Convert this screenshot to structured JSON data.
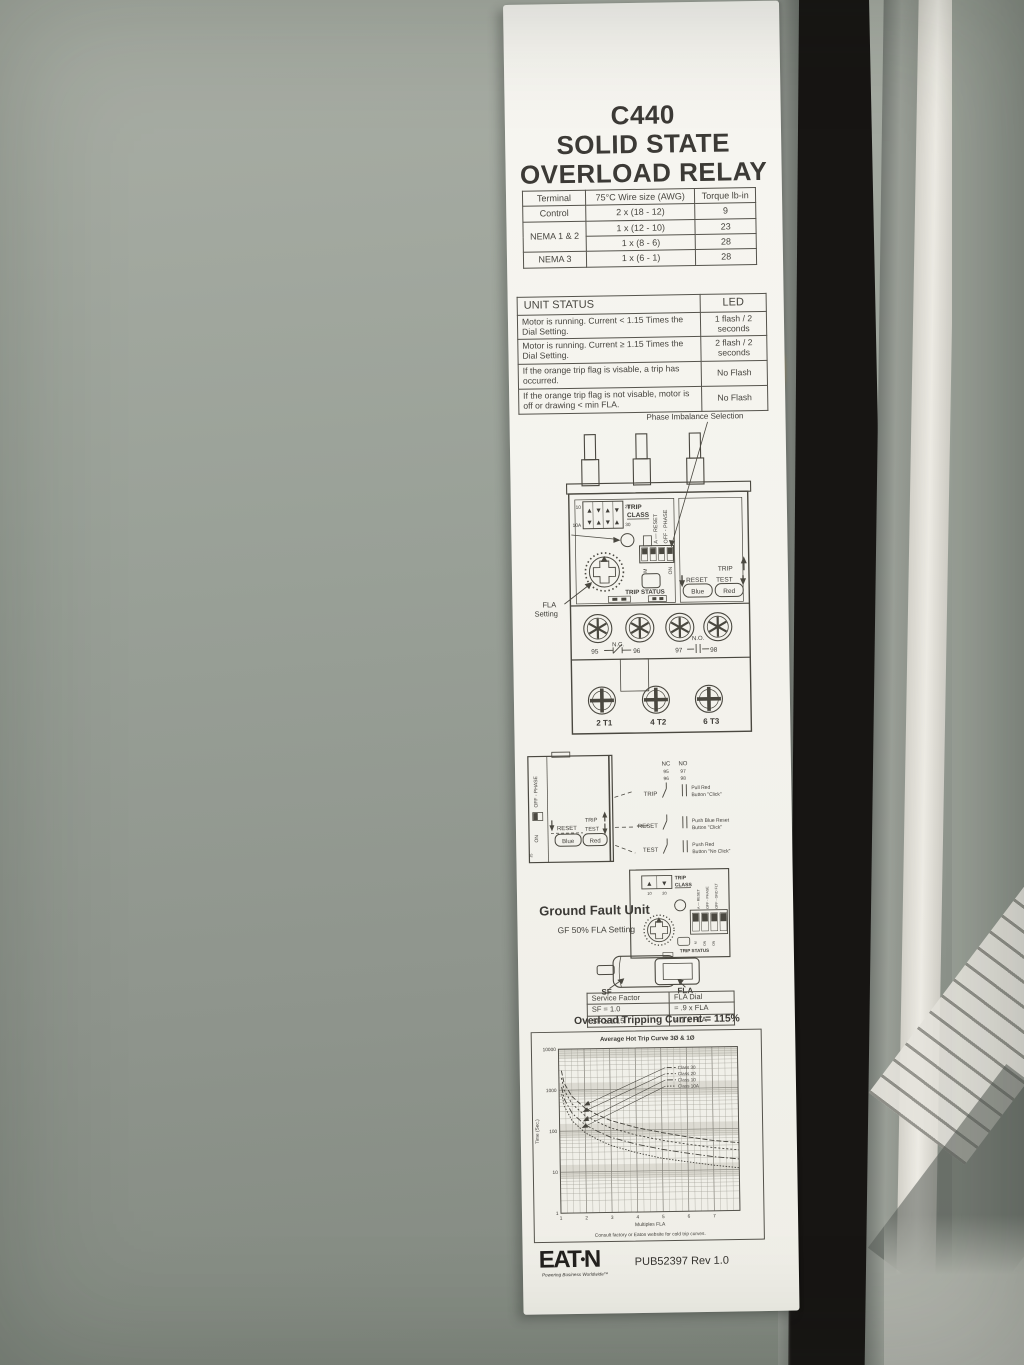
{
  "colors": {
    "panel": "#9aa098",
    "label_bg": "#f5f4ef",
    "ink": "#3f3d38",
    "gasket": "#171513",
    "highlight": "#efede6"
  },
  "label": {
    "title": [
      "C440",
      "SOLID STATE",
      "OVERLOAD RELAY"
    ],
    "wire_table": {
      "headers": [
        "Terminal",
        "75°C Wire size (AWG)",
        "Torque lb-in"
      ],
      "rows": [
        {
          "terminal": "Control",
          "wire": "2 x (18 - 12)",
          "torque": "9"
        },
        {
          "terminal": "NEMA 1 & 2",
          "wire": "1 x (12 - 10)",
          "torque": "23"
        },
        {
          "terminal": "",
          "wire": "1 x (8 - 6)",
          "torque": "28"
        },
        {
          "terminal": "NEMA 3",
          "wire": "1 x (6 - 1)",
          "torque": "28"
        }
      ]
    },
    "unit_status_table": {
      "headers": [
        "UNIT STATUS",
        "LED"
      ],
      "rows": [
        {
          "status": "Motor is running. Current < 1.15 Times the Dial Setting.",
          "led": "1 flash / 2 seconds"
        },
        {
          "status": "Motor is running. Current ≥ 1.15 Times the Dial Setting.",
          "led": "2 flash / 2 seconds"
        },
        {
          "status": "If the orange trip flag is visable, a trip has occurred.",
          "led": "No Flash"
        },
        {
          "status": "If the orange trip flag is not visable, motor is off or drawing < min FLA.",
          "led": "No Flash"
        }
      ]
    },
    "device": {
      "phase_imbalance": "Phase Imbalance Selection",
      "trip": "TRIP",
      "class": "CLASS",
      "classes": [
        "10",
        "20",
        "10A",
        "30"
      ],
      "arrows_row1": "▲▼▲▼",
      "arrows_row2": "▼▲▼▲",
      "dip_top": [
        "A — RESET",
        "OFF - PHASE"
      ],
      "dip_bottom": [
        "M",
        "ON"
      ],
      "trip_status": "TRIP STATUS",
      "fla_l1": "FLA",
      "fla_l2": "Setting",
      "trip_label": "TRIP",
      "reset_label": "RESET",
      "test_label": "TEST",
      "blue": "Blue",
      "red": "Red",
      "nc": "N.C.",
      "no": "N.O.",
      "n95": "95",
      "n96": "96",
      "n97": "97",
      "n98": "98",
      "t1": "2 T1",
      "t2": "4 T2",
      "t3": "6 T3"
    },
    "mid": {
      "off_phase": "OFF - PHASE",
      "on": "ON",
      "j5": "J5",
      "reset": "RESET",
      "trip": "TRIP",
      "test": "TEST",
      "blue": "Blue",
      "red": "Red",
      "nc": "NC",
      "no": "NO",
      "r95": "95",
      "r97": "97",
      "r96": "96",
      "r98": "98",
      "rows": [
        {
          "name": "TRIP",
          "desc1": "Pull Red",
          "desc2": "Button \"Click\""
        },
        {
          "name": "RESET",
          "desc1": "Push Blue Reset",
          "desc2": "Button \"Click\""
        },
        {
          "name": "TEST",
          "desc1": "Push Red",
          "desc2": "Button \"No Click\""
        }
      ]
    },
    "gf": {
      "title": "Ground Fault Unit",
      "subtitle": "GF 50% FLA Setting",
      "trip": "TRIP",
      "class": "CLASS",
      "c10": "10",
      "c20": "20",
      "dip_top": [
        "A — RESET",
        "OFF - PHASE",
        "OFF - GND FLT"
      ],
      "dip_bottom": [
        "M",
        "ON",
        "ON"
      ],
      "trip_status": "TRIP STATUS"
    },
    "sf": {
      "sf": "SF",
      "fla": "FLA"
    },
    "service_table": {
      "headers": [
        "Service Factor",
        "FLA Dial"
      ],
      "rows": [
        [
          "SF = 1.0",
          "= .9 x FLA"
        ],
        [
          "SF ≥ 1.15",
          "= 1 x FLA"
        ]
      ]
    },
    "overload_line": "Overload Tripping Current = 115%",
    "footer": {
      "brand_e": "E",
      "brand_a": "A",
      "brand_t": "T",
      "brand_dot": "•",
      "brand_n": "N",
      "tagline": "Powering Business Worldwide™",
      "pub": "PUB52397 Rev 1.0"
    }
  },
  "chart_data": {
    "type": "line",
    "title": "Average Hot Trip Curve 3Ø & 1Ø",
    "xlabel": "Multiples FLA",
    "ylabel": "Time (Sec.)",
    "note": "Consult factory or Eaton website for cold trip curves.",
    "x_ticks": [
      1,
      2,
      3,
      4,
      5,
      6,
      7
    ],
    "y_ticks": [
      10000,
      1000,
      100,
      10,
      1
    ],
    "xlim": [
      1,
      8
    ],
    "ylim": [
      1,
      10000
    ],
    "y_log": true,
    "grid": true,
    "legend_position": "upper right",
    "series": [
      {
        "name": "Class 30",
        "dash": "5,2",
        "arrow_x": 1.95,
        "points": [
          [
            1.1,
            3000
          ],
          [
            1.2,
            1500
          ],
          [
            1.5,
            700
          ],
          [
            2,
            360
          ],
          [
            2.5,
            240
          ],
          [
            3,
            175
          ],
          [
            4,
            115
          ],
          [
            5,
            85
          ],
          [
            6,
            65
          ],
          [
            7,
            52
          ],
          [
            8,
            45
          ]
        ]
      },
      {
        "name": "Class 20",
        "dash": "2,2",
        "arrow_x": 1.9,
        "points": [
          [
            1.1,
            2000
          ],
          [
            1.2,
            1000
          ],
          [
            1.5,
            460
          ],
          [
            2,
            235
          ],
          [
            2.5,
            160
          ],
          [
            3,
            115
          ],
          [
            4,
            75
          ],
          [
            5,
            55
          ],
          [
            6,
            43
          ],
          [
            7,
            35
          ],
          [
            8,
            30
          ]
        ]
      },
      {
        "name": "Class 10",
        "dash": "6,2,1.5,2",
        "arrow_x": 1.9,
        "points": [
          [
            1.1,
            1200
          ],
          [
            1.2,
            600
          ],
          [
            1.5,
            270
          ],
          [
            2,
            140
          ],
          [
            2.5,
            95
          ],
          [
            3,
            68
          ],
          [
            4,
            45
          ],
          [
            5,
            33
          ],
          [
            6,
            26
          ],
          [
            7,
            21
          ],
          [
            8,
            18
          ]
        ]
      },
      {
        "name": "Class 10A",
        "dash": "1.5,1.5",
        "arrow_x": 1.85,
        "points": [
          [
            1.1,
            800
          ],
          [
            1.2,
            400
          ],
          [
            1.5,
            175
          ],
          [
            2,
            90
          ],
          [
            2.5,
            60
          ],
          [
            3,
            43
          ],
          [
            4,
            28
          ],
          [
            5,
            20
          ],
          [
            6,
            16
          ],
          [
            7,
            13
          ],
          [
            8,
            11
          ]
        ]
      }
    ]
  }
}
